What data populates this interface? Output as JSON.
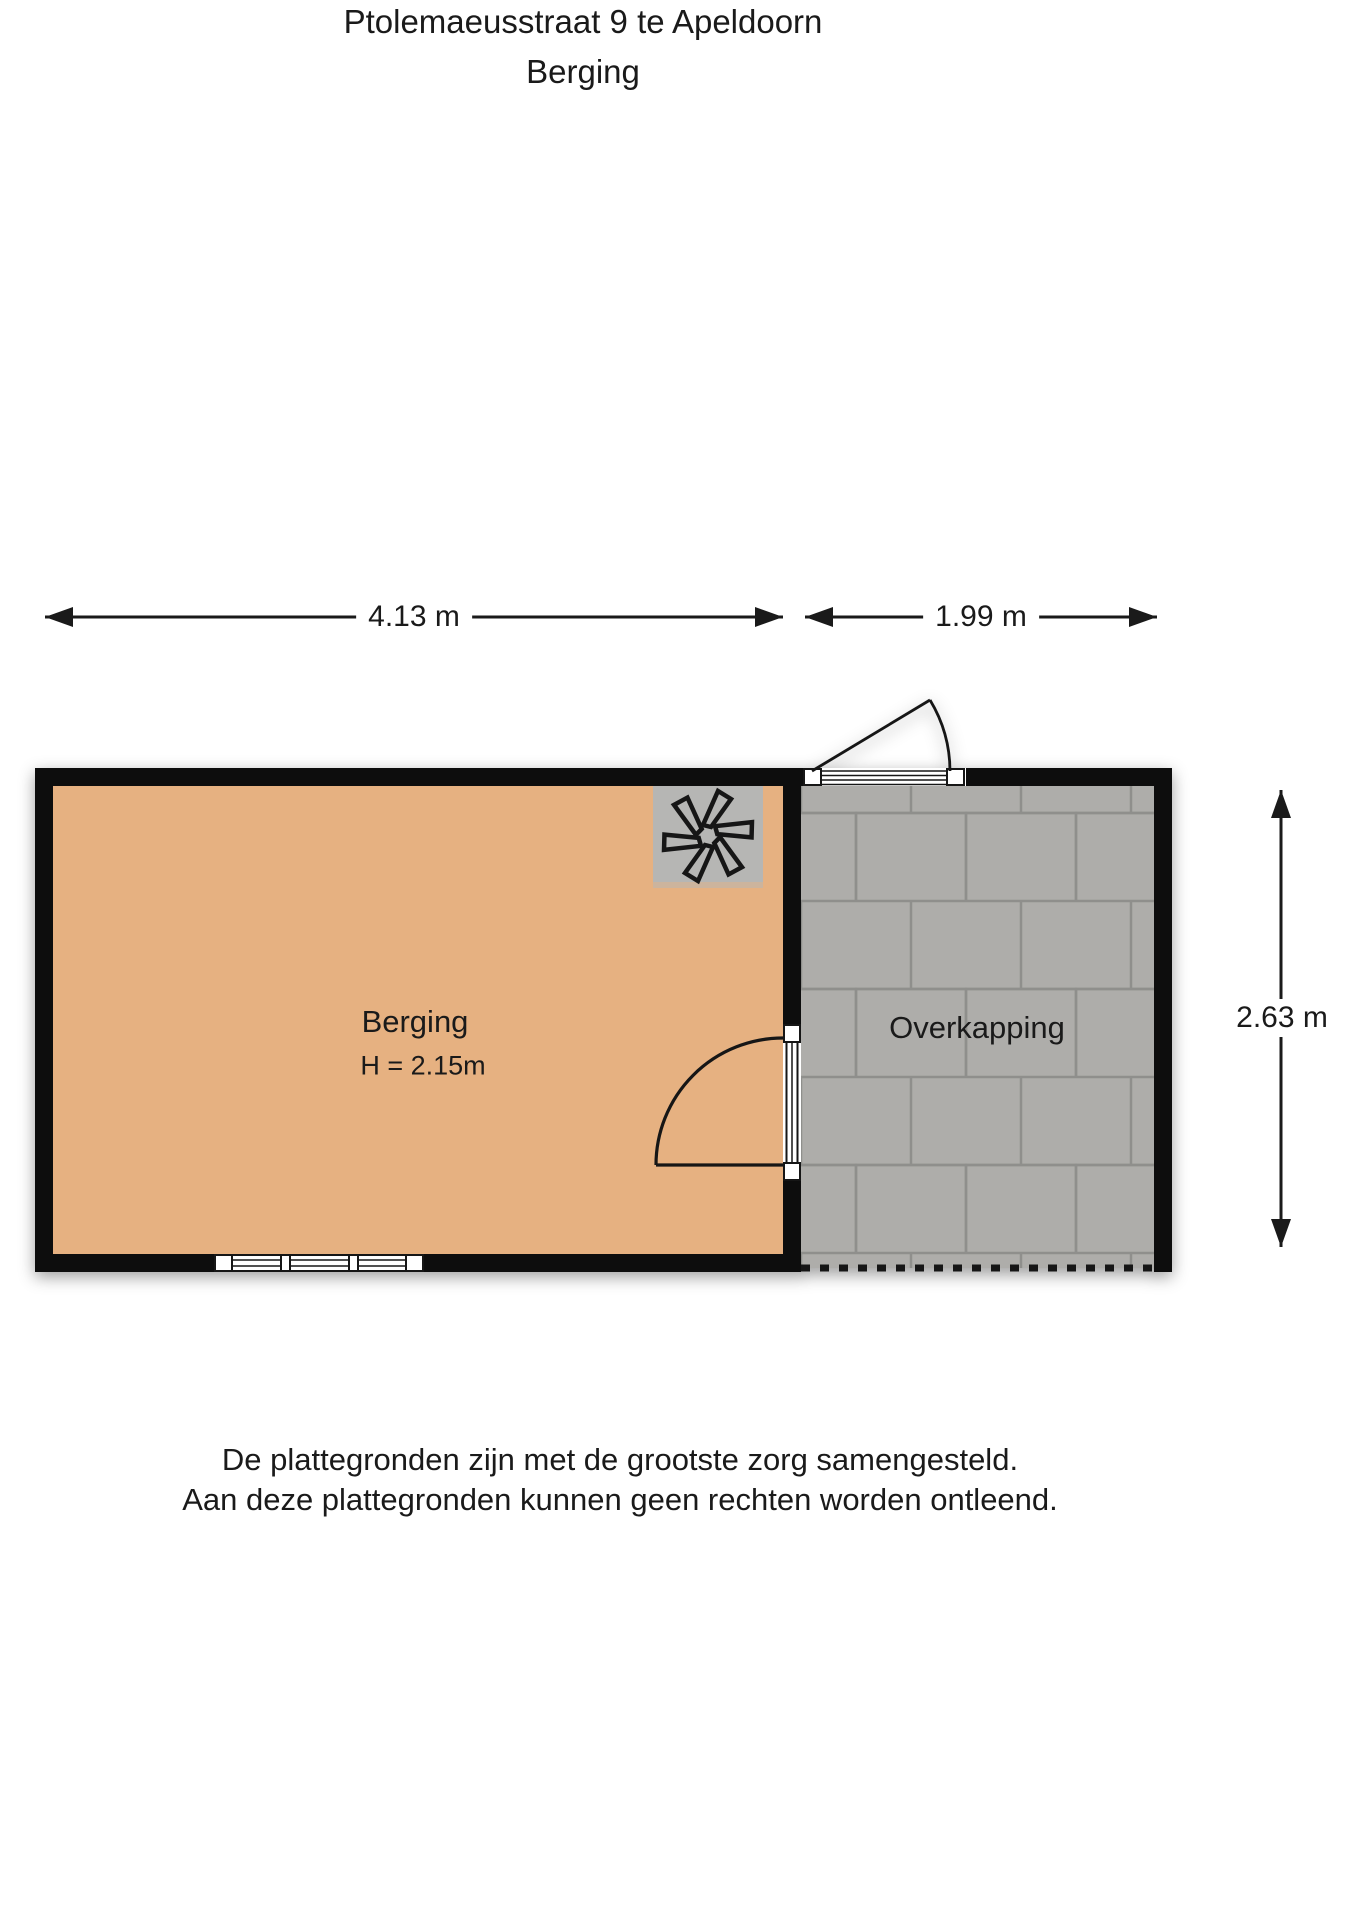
{
  "header": {
    "title": "Ptolemaeusstraat 9 te Apeldoorn",
    "subtitle": "Berging"
  },
  "dimensions": {
    "top_left_width": "4.13 m",
    "top_right_width": "1.99 m",
    "right_height": "2.63 m"
  },
  "rooms": {
    "berging": {
      "label": "Berging",
      "ceiling_height": "H = 2.15m"
    },
    "overkapping": {
      "label": "Overkapping"
    }
  },
  "footer": {
    "line1": "De plattegronden zijn met de grootste zorg samengesteld.",
    "line2": "Aan deze plattegronden kunnen geen rechten worden ontleend."
  },
  "icons": {
    "ventilation_fan": "✳"
  },
  "colors": {
    "wall": "#0f0f0f",
    "floor_berging": "#e6b181",
    "floor_overkapping": "#aeadaa",
    "tile_joint": "#8f8f8c",
    "fan_box": "#b6b6b4",
    "line": "#1a1a1a",
    "text": "#1a1a1a"
  }
}
